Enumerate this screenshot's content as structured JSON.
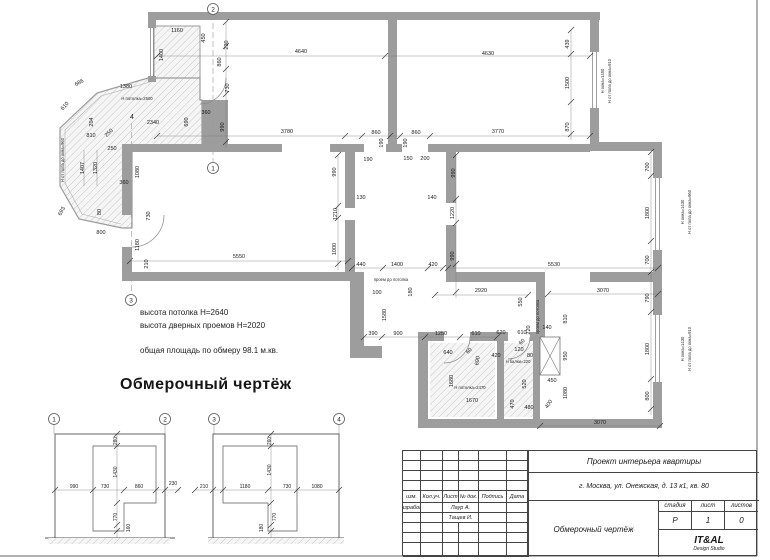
{
  "title": {
    "text": "Обмерочный чертёж"
  },
  "notes": {
    "line1": "высота потолка Н=2640",
    "line2": "высота дверных проемов Н=2020",
    "line3": "общая площадь по обмеру 98.1 м.кв."
  },
  "colors": {
    "wall": "#9d9d9d",
    "hatch_line": "#c8c8c8",
    "dim_text": "#1b1b1b",
    "line": "#555555"
  },
  "plan": {
    "dims": [
      {
        "t": "1160",
        "x": 177,
        "y": 32
      },
      {
        "t": "450",
        "x": 205,
        "y": 38,
        "r": -90
      },
      {
        "t": "230",
        "x": 228,
        "y": 45,
        "r": -90
      },
      {
        "t": "1400",
        "x": 163,
        "y": 55,
        "r": -90
      },
      {
        "t": "860",
        "x": 221,
        "y": 62,
        "r": -90
      },
      {
        "t": "730",
        "x": 229,
        "y": 88,
        "r": -90
      },
      {
        "t": "1380",
        "x": 126,
        "y": 88
      },
      {
        "t": "686",
        "x": 80,
        "y": 84,
        "r": -30
      },
      {
        "t": "610",
        "x": 66,
        "y": 107,
        "r": -50
      },
      {
        "t": "204",
        "x": 93,
        "y": 122,
        "r": -90
      },
      {
        "t": "2340",
        "x": 153,
        "y": 124
      },
      {
        "t": "690",
        "x": 188,
        "y": 122,
        "r": -90
      },
      {
        "t": "360",
        "x": 206,
        "y": 114
      },
      {
        "t": "990",
        "x": 224,
        "y": 127,
        "r": -90
      },
      {
        "t": "810",
        "x": 91,
        "y": 137
      },
      {
        "t": "250",
        "x": 110,
        "y": 134,
        "r": -45
      },
      {
        "t": "250",
        "x": 112,
        "y": 150
      },
      {
        "t": "4",
        "x": 132,
        "y": 119,
        "s": 7
      },
      {
        "t": "1407",
        "x": 84,
        "y": 168,
        "r": -90
      },
      {
        "t": "1320",
        "x": 97,
        "y": 168,
        "r": -90
      },
      {
        "t": "1080",
        "x": 139,
        "y": 172,
        "r": -90
      },
      {
        "t": "360",
        "x": 124,
        "y": 184
      },
      {
        "t": "693",
        "x": 63,
        "y": 212,
        "r": -60
      },
      {
        "t": "80",
        "x": 101,
        "y": 212,
        "r": -90
      },
      {
        "t": "800",
        "x": 101,
        "y": 234
      },
      {
        "t": "730",
        "x": 150,
        "y": 216,
        "r": -90
      },
      {
        "t": "1180",
        "x": 139,
        "y": 245,
        "r": -90
      },
      {
        "t": "210",
        "x": 148,
        "y": 264,
        "r": -90
      },
      {
        "t": "4640",
        "x": 301,
        "y": 53
      },
      {
        "t": "4630",
        "x": 488,
        "y": 55
      },
      {
        "t": "3780",
        "x": 287,
        "y": 133
      },
      {
        "t": "860",
        "x": 376,
        "y": 134
      },
      {
        "t": "860",
        "x": 416,
        "y": 134
      },
      {
        "t": "3770",
        "x": 498,
        "y": 133
      },
      {
        "t": "190",
        "x": 383,
        "y": 143,
        "r": -90
      },
      {
        "t": "190",
        "x": 407,
        "y": 143,
        "r": -90
      },
      {
        "t": "439",
        "x": 569,
        "y": 44,
        "r": -90
      },
      {
        "t": "1500",
        "x": 569,
        "y": 83,
        "r": -90
      },
      {
        "t": "870",
        "x": 569,
        "y": 127,
        "r": -90
      },
      {
        "t": "190",
        "x": 368,
        "y": 161
      },
      {
        "t": "150",
        "x": 408,
        "y": 160
      },
      {
        "t": "200",
        "x": 425,
        "y": 160
      },
      {
        "t": "990",
        "x": 336,
        "y": 172,
        "r": -90
      },
      {
        "t": "990",
        "x": 455,
        "y": 173,
        "r": -90
      },
      {
        "t": "130",
        "x": 361,
        "y": 199
      },
      {
        "t": "140",
        "x": 432,
        "y": 199
      },
      {
        "t": "1210",
        "x": 337,
        "y": 214,
        "r": -90
      },
      {
        "t": "1220",
        "x": 454,
        "y": 213,
        "r": -90
      },
      {
        "t": "1000",
        "x": 336,
        "y": 249,
        "r": -90
      },
      {
        "t": "990",
        "x": 454,
        "y": 256,
        "r": -90
      },
      {
        "t": "5550",
        "x": 239,
        "y": 258
      },
      {
        "t": "440",
        "x": 361,
        "y": 266
      },
      {
        "t": "1400",
        "x": 397,
        "y": 266
      },
      {
        "t": "420",
        "x": 433,
        "y": 266
      },
      {
        "t": "5530",
        "x": 554,
        "y": 266
      },
      {
        "t": "700",
        "x": 649,
        "y": 167,
        "r": -90
      },
      {
        "t": "1800",
        "x": 649,
        "y": 213,
        "r": -90
      },
      {
        "t": "700",
        "x": 649,
        "y": 260,
        "r": -90
      },
      {
        "t": "3070",
        "x": 603,
        "y": 292
      },
      {
        "t": "790",
        "x": 649,
        "y": 298,
        "r": -90
      },
      {
        "t": "100",
        "x": 377,
        "y": 294
      },
      {
        "t": "180",
        "x": 412,
        "y": 292,
        "r": -90
      },
      {
        "t": "1580",
        "x": 386,
        "y": 315,
        "r": -90
      },
      {
        "t": "2920",
        "x": 481,
        "y": 292
      },
      {
        "t": "550",
        "x": 522,
        "y": 302,
        "r": -90
      },
      {
        "t": "220",
        "x": 530,
        "y": 330,
        "r": -90
      },
      {
        "t": "140",
        "x": 547,
        "y": 329
      },
      {
        "t": "810",
        "x": 567,
        "y": 319,
        "r": -90
      },
      {
        "t": "390",
        "x": 373,
        "y": 335
      },
      {
        "t": "900",
        "x": 398,
        "y": 335
      },
      {
        "t": "1250",
        "x": 441,
        "y": 335
      },
      {
        "t": "610",
        "x": 476,
        "y": 335
      },
      {
        "t": "620",
        "x": 501,
        "y": 334
      },
      {
        "t": "610",
        "x": 522,
        "y": 334
      },
      {
        "t": "640",
        "x": 448,
        "y": 354
      },
      {
        "t": "60",
        "x": 470,
        "y": 352,
        "r": -45
      },
      {
        "t": "690",
        "x": 479,
        "y": 361,
        "r": -80
      },
      {
        "t": "420",
        "x": 496,
        "y": 357
      },
      {
        "t": "60",
        "x": 523,
        "y": 343,
        "r": -45
      },
      {
        "t": "120",
        "x": 519,
        "y": 351
      },
      {
        "t": "80",
        "x": 530,
        "y": 357
      },
      {
        "t": "950",
        "x": 567,
        "y": 356,
        "r": -90
      },
      {
        "t": "1680",
        "x": 453,
        "y": 381,
        "r": -90
      },
      {
        "t": "1670",
        "x": 472,
        "y": 402
      },
      {
        "t": "520",
        "x": 526,
        "y": 384,
        "r": -90
      },
      {
        "t": "450",
        "x": 552,
        "y": 382
      },
      {
        "t": "1080",
        "x": 567,
        "y": 393,
        "r": -90
      },
      {
        "t": "470",
        "x": 514,
        "y": 404,
        "r": -90
      },
      {
        "t": "400",
        "x": 550,
        "y": 405,
        "r": -55
      },
      {
        "t": "480",
        "x": 529,
        "y": 409
      },
      {
        "t": "3070",
        "x": 600,
        "y": 424
      },
      {
        "t": "1800",
        "x": 649,
        "y": 349,
        "r": -90
      },
      {
        "t": "800",
        "x": 649,
        "y": 396,
        "r": -90
      },
      {
        "t": "280",
        "x": 117,
        "y": 441,
        "r": -90,
        "s": 5
      },
      {
        "t": "1430",
        "x": 117,
        "y": 472,
        "r": -90,
        "s": 5
      },
      {
        "t": "990",
        "x": 74,
        "y": 488,
        "s": 5
      },
      {
        "t": "730",
        "x": 105,
        "y": 488,
        "s": 5
      },
      {
        "t": "860",
        "x": 139,
        "y": 488,
        "s": 5
      },
      {
        "t": "230",
        "x": 173,
        "y": 485,
        "s": 5
      },
      {
        "t": "770",
        "x": 117,
        "y": 517,
        "r": -90,
        "s": 5
      },
      {
        "t": "160",
        "x": 130,
        "y": 528,
        "r": -90,
        "s": 5
      },
      {
        "t": "260",
        "x": 271,
        "y": 441,
        "r": -90,
        "s": 5
      },
      {
        "t": "1430",
        "x": 271,
        "y": 470,
        "r": -90,
        "s": 5
      },
      {
        "t": "210",
        "x": 204,
        "y": 488,
        "s": 5
      },
      {
        "t": "1180",
        "x": 245,
        "y": 488,
        "s": 5
      },
      {
        "t": "730",
        "x": 287,
        "y": 488,
        "s": 5
      },
      {
        "t": "1080",
        "x": 317,
        "y": 488,
        "s": 5
      },
      {
        "t": "770",
        "x": 276,
        "y": 517,
        "r": -90,
        "s": 5
      },
      {
        "t": "180",
        "x": 263,
        "y": 528,
        "r": -90,
        "s": 5
      }
    ],
    "small_labels": [
      {
        "t": "Н потолка=2500",
        "x": 137,
        "y": 100
      },
      {
        "t": "Н от пола до окна=960",
        "x": 64,
        "y": 160,
        "r": -90
      },
      {
        "t": "Н окна=1450",
        "x": 604,
        "y": 81,
        "r": -90
      },
      {
        "t": "Н от пола до окна=910",
        "x": 611,
        "y": 81,
        "r": -90
      },
      {
        "t": "Н окна=1430",
        "x": 684,
        "y": 212,
        "r": -90
      },
      {
        "t": "Н от пола до окна=960",
        "x": 691,
        "y": 212,
        "r": -90
      },
      {
        "t": "Н окна=1430",
        "x": 684,
        "y": 349,
        "r": -90
      },
      {
        "t": "Н от пола до окна=910",
        "x": 691,
        "y": 349,
        "r": -90
      },
      {
        "t": "проем до потолка",
        "x": 391,
        "y": 281
      },
      {
        "t": "проем до потолка",
        "x": 539,
        "y": 317,
        "r": -90
      },
      {
        "t": "Н балки=220",
        "x": 518,
        "y": 363
      },
      {
        "t": "Н потолка=2470",
        "x": 470,
        "y": 389
      }
    ],
    "markers": [
      {
        "n": "2",
        "x": 213,
        "y": 9
      },
      {
        "n": "1",
        "x": 213,
        "y": 168
      },
      {
        "n": "3",
        "x": 131,
        "y": 300
      },
      {
        "n": "1",
        "x": 54,
        "y": 419
      },
      {
        "n": "2",
        "x": 165,
        "y": 419
      },
      {
        "n": "3",
        "x": 214,
        "y": 419
      },
      {
        "n": "4",
        "x": 339,
        "y": 419
      }
    ]
  },
  "titleblock": {
    "project": "Проект интерьера квартиры",
    "address": "г. Москва, ул. Онежская, д. 13 к1, кв. 80",
    "drawing_name": "Обмерочный чертёж",
    "columns": [
      "изм.",
      "Кол.уч.",
      "Лист",
      "№ док.",
      "Подпись",
      "Дата"
    ],
    "developed_label": "Разработ.",
    "developer_1": "Лаур А.",
    "developer_2": "Тащев И.",
    "stage_label": "стадия",
    "sheet_label": "лист",
    "sheets_label": "листов",
    "stage_value": "Р",
    "sheet_value": "1",
    "sheets_value": "0",
    "studio_name": "IT&AL",
    "studio_sub": "Design Studio"
  }
}
